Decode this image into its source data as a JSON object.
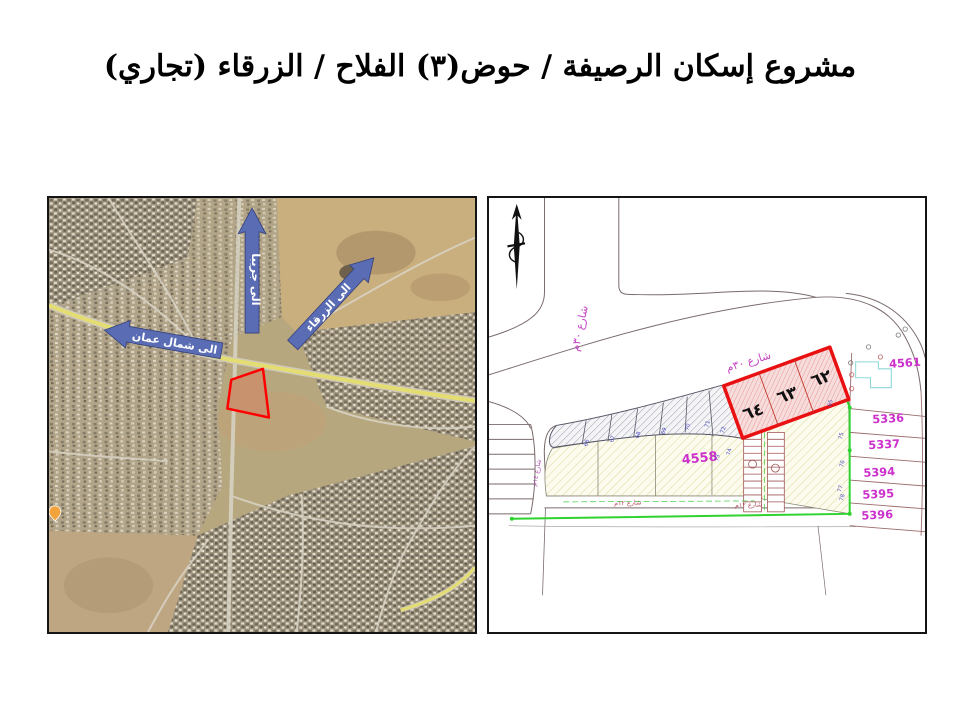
{
  "slide": {
    "title": "مشروع إسكان الرصيفة / حوض(٣) الفلاح / الزرقاء (تجاري)"
  },
  "location_map": {
    "arrow_north_label": "الى جريبا",
    "arrow_east_label": "الى الزرقاء",
    "arrow_west_label": "الى شمال عمان"
  },
  "site_plan": {
    "street_30_left": "شارع ٣٠م",
    "street_30_main": "شارع ٣٠م",
    "street_14": "شارع ١٤م",
    "street_12_a": "شارع ١٢م",
    "street_12_b": "شارع ١٢م",
    "block_4558": "4558",
    "parcel_4561": "4561",
    "parcel_5336": "5336",
    "parcel_5337": "5337",
    "parcel_5394": "5394",
    "parcel_5395": "5395",
    "parcel_5396": "5396",
    "plot_62": "٦٢",
    "plot_63": "٦٣",
    "plot_64": "٦٤",
    "points": {
      "n65": "65",
      "n66": "66",
      "n67": "67",
      "n68": "68",
      "n69": "69",
      "n70": "70",
      "n71": "71",
      "n72": "72",
      "n73": "73",
      "n74": "74",
      "n75": "75",
      "n76": "76",
      "n77": "77",
      "n78": "78"
    }
  },
  "colors": {
    "site_outline_red": "#ff0000",
    "highlight_outline_red": "#e81010",
    "arrow_blue": "#5a6db4",
    "parcel_number_magenta": "#cc2fcc",
    "boundary_green": "#2fd32f",
    "point_number_blue": "#4a4ac0"
  }
}
